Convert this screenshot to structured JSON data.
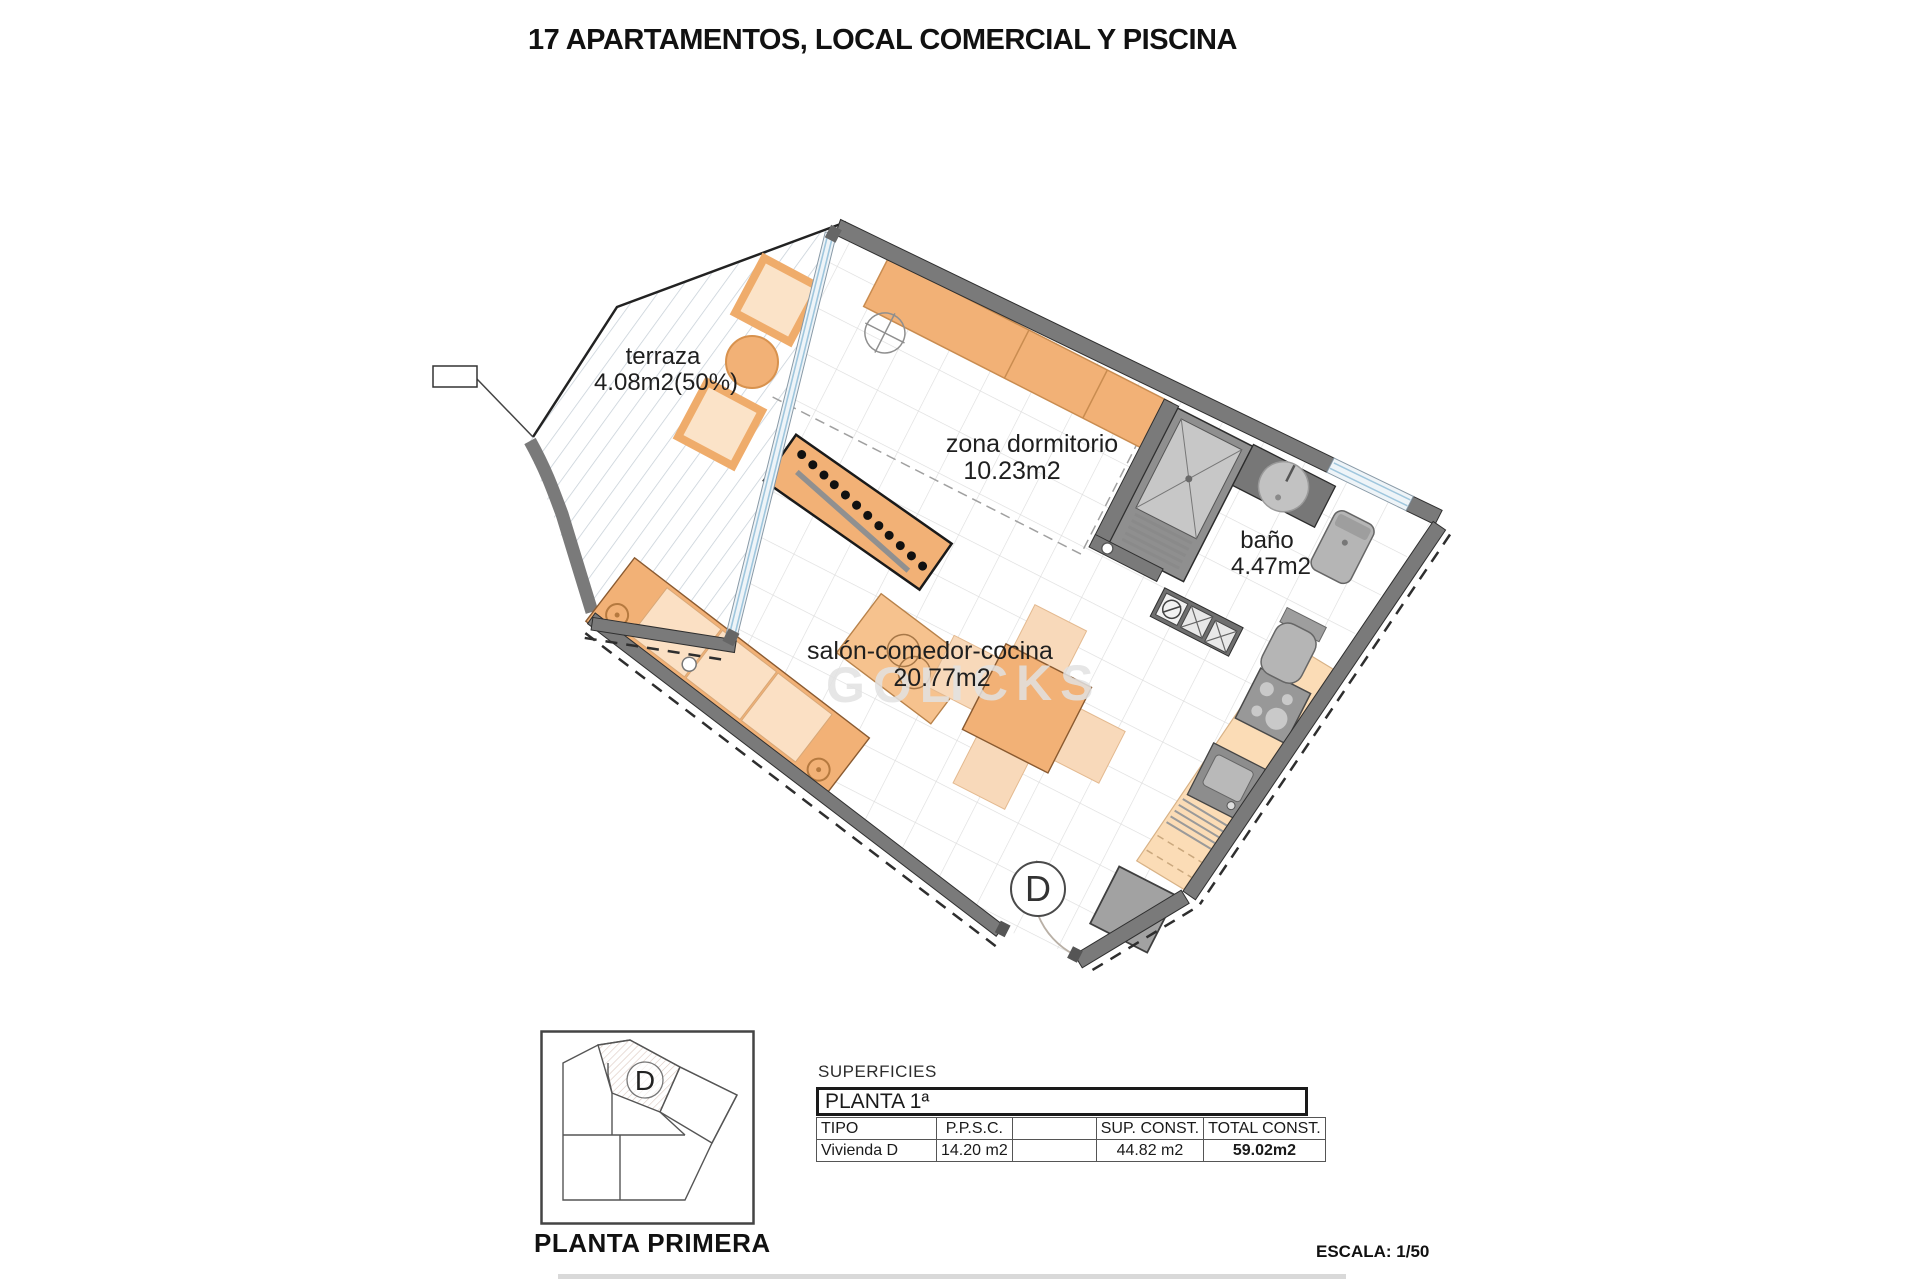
{
  "title": "17 APARTAMENTOS, LOCAL COMERCIAL Y PISCINA",
  "plan": {
    "rooms": {
      "terraza": {
        "name": "terraza",
        "area": "4.08m2(50%)"
      },
      "dormitorio": {
        "name": "zona dormitorio",
        "area": "10.23m2"
      },
      "bano": {
        "name": "baño",
        "area": "4.47m2"
      },
      "salon": {
        "name": "salón-comedor-cocina",
        "area": "20.77m2"
      }
    },
    "door_label": "D",
    "watermark": {
      "left": "GOL",
      "right": "ICKS"
    }
  },
  "key_plan": {
    "unit_label": "D",
    "caption": "PLANTA PRIMERA"
  },
  "surfaces": {
    "section_label": "SUPERFICIES",
    "floor_label": "PLANTA 1ª",
    "headers": [
      "TIPO",
      "P.P.S.C.",
      "",
      "SUP. CONST.",
      "TOTAL CONST."
    ],
    "rows": [
      [
        "Vivienda D",
        "14.20 m2",
        "",
        "44.82 m2",
        "59.02m2"
      ]
    ]
  },
  "scale_note": "ESCALA: 1/50",
  "colors": {
    "wall_gray": "#7a7a7a",
    "furniture_orange": "#f2b176",
    "furniture_light": "#fbe0c4",
    "counter_peach": "#fbdcb6",
    "glass_blue": "#9fc6dd",
    "tile_line": "#dcdcdc"
  }
}
